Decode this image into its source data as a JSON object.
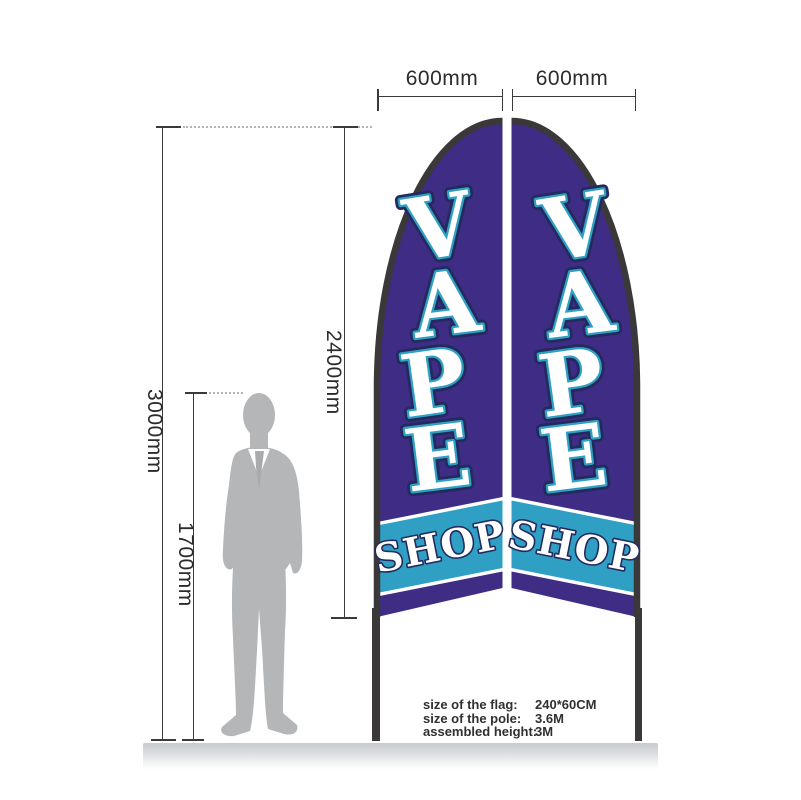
{
  "dimensions": {
    "flag_width_left": "600mm",
    "flag_width_right": "600mm",
    "assembled_height": "3000mm",
    "flag_length": "2400mm",
    "person_height": "1700mm"
  },
  "flags": {
    "letters": [
      "V",
      "A",
      "P",
      "E"
    ],
    "shop": "SHOP"
  },
  "specs": {
    "rows": [
      {
        "label": "size of the flag:",
        "value": "240*60CM"
      },
      {
        "label": "size of the pole:",
        "value": "3.6M"
      },
      {
        "label": "assembled height:",
        "value": "3M"
      }
    ]
  },
  "colors": {
    "purple": "#3e2c85",
    "teal": "#2f9fc4",
    "navy": "#232a5e",
    "pole": "#3b383a",
    "person": "#b4b6b8",
    "line": "#3a3a3a",
    "ground": "#c9cbcd"
  }
}
